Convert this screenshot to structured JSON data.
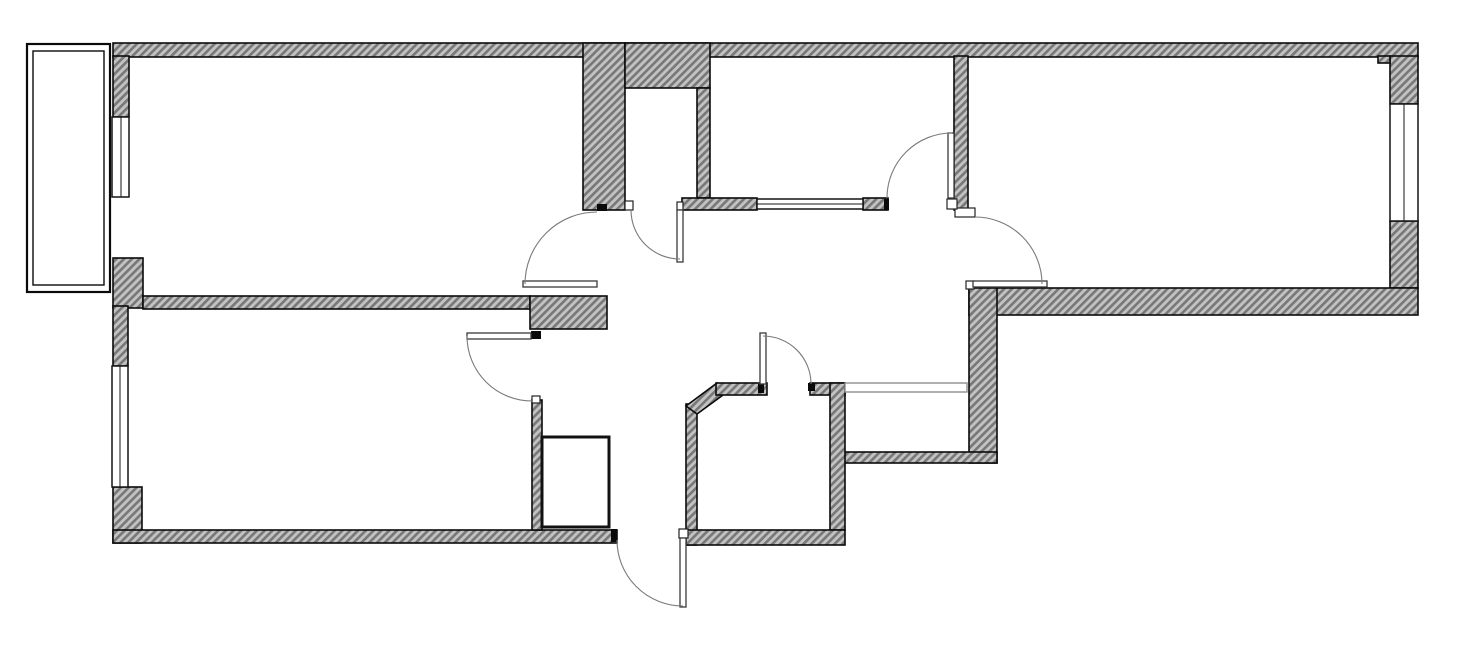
{
  "meta": {
    "description": "Black-and-white architectural floor plan of a two-bedroom apartment with balcony, drawn with hatched walls, swing-arc doors and framed windows. No text labels are rendered on the drawing.",
    "background_color": "#ffffff"
  },
  "palette": {
    "line": "#0a0a0a",
    "hatch_base": "#c2c2c2",
    "hatch_stripe": "#777777",
    "door_arc": "#7a7a7a",
    "light_partition": "#8f8f8f",
    "paper": "#ffffff"
  },
  "inventory": {
    "rooms": [
      "top-left-room",
      "bottom-left-room",
      "top-middle-room",
      "right-room",
      "hallway",
      "entrance-hall",
      "bathroom",
      "duct-shaft",
      "wall-closet",
      "balcony"
    ],
    "door_count": 7,
    "window_count": 4,
    "swing_door_arcs": 7
  },
  "plan": {
    "width": 1459,
    "height": 650,
    "shapes": [
      {
        "t": "rect",
        "cls": "wall",
        "name": "top-exterior-wall",
        "x": 113,
        "y": 43,
        "w": 1305,
        "h": 14
      },
      {
        "t": "rect",
        "cls": "wall",
        "name": "left-exterior-wall-upper",
        "x": 113,
        "y": 56,
        "w": 16,
        "h": 61
      },
      {
        "t": "rect",
        "cls": "wall",
        "name": "left-exterior-wall-pier",
        "x": 113,
        "y": 258,
        "w": 30,
        "h": 50
      },
      {
        "t": "rect",
        "cls": "wall",
        "name": "left-exterior-wall-mid",
        "x": 113,
        "y": 306,
        "w": 15,
        "h": 60
      },
      {
        "t": "rect",
        "cls": "wall",
        "name": "left-exterior-wall-lower",
        "x": 113,
        "y": 487,
        "w": 29,
        "h": 56
      },
      {
        "t": "rect",
        "cls": "wall",
        "name": "bottom-exterior-wall-left",
        "x": 113,
        "y": 530,
        "w": 504,
        "h": 13
      },
      {
        "t": "rect",
        "cls": "wall",
        "name": "right-exterior-wall-upper",
        "x": 1390,
        "y": 56,
        "w": 28,
        "h": 48
      },
      {
        "t": "rect",
        "cls": "wall",
        "name": "right-exterior-wall-lower",
        "x": 1390,
        "y": 221,
        "w": 28,
        "h": 67
      },
      {
        "t": "rect",
        "cls": "wall",
        "name": "right-room-bottom-wall",
        "x": 969,
        "y": 288,
        "w": 449,
        "h": 27
      },
      {
        "t": "rect",
        "cls": "wall",
        "name": "hallway-right-wall",
        "x": 969,
        "y": 288,
        "w": 28,
        "h": 175
      },
      {
        "t": "rect",
        "cls": "wall",
        "name": "duct-shaft-bottom-wall",
        "x": 843,
        "y": 452,
        "w": 154,
        "h": 11
      },
      {
        "t": "rect",
        "cls": "wall",
        "name": "closet-left-column",
        "x": 583,
        "y": 43,
        "w": 42,
        "h": 167
      },
      {
        "t": "rect",
        "cls": "wall",
        "name": "closet-top-wall",
        "x": 625,
        "y": 43,
        "w": 85,
        "h": 45
      },
      {
        "t": "rect",
        "cls": "wall",
        "name": "closet-right-wall",
        "x": 697,
        "y": 88,
        "w": 13,
        "h": 110
      },
      {
        "t": "rect",
        "cls": "wall",
        "name": "middleroom-bottom-wall-left",
        "x": 682,
        "y": 198,
        "w": 75,
        "h": 12
      },
      {
        "t": "rect",
        "cls": "wall",
        "name": "middleroom-bottom-wall-right",
        "x": 863,
        "y": 198,
        "w": 25,
        "h": 12
      },
      {
        "t": "rect",
        "cls": "wall",
        "name": "middleroom-right-wall",
        "x": 954,
        "y": 56,
        "w": 14,
        "h": 154
      },
      {
        "t": "rect",
        "cls": "wall",
        "name": "rooms-divider-wall",
        "x": 143,
        "y": 296,
        "w": 387,
        "h": 13
      },
      {
        "t": "rect",
        "cls": "wall",
        "name": "hall-doorway-pier",
        "x": 530,
        "y": 296,
        "w": 77,
        "h": 33
      },
      {
        "t": "rect",
        "cls": "wall",
        "name": "bottomroom-right-wall",
        "x": 532,
        "y": 400,
        "w": 10,
        "h": 130
      },
      {
        "t": "rect",
        "cls": "wall",
        "name": "bathroom-left-wall",
        "x": 686,
        "y": 404,
        "w": 11,
        "h": 141
      },
      {
        "t": "poly",
        "cls": "wall",
        "name": "bathroom-chamfer-wall",
        "pts": "686,406 717,383 723,395 697,414"
      },
      {
        "t": "rect",
        "cls": "wall",
        "name": "bathroom-top-wall-left",
        "x": 716,
        "y": 383,
        "w": 51,
        "h": 12
      },
      {
        "t": "rect",
        "cls": "wall",
        "name": "bathroom-top-wall-right",
        "x": 810,
        "y": 383,
        "w": 35,
        "h": 12
      },
      {
        "t": "rect",
        "cls": "wall",
        "name": "bathroom-right-wall",
        "x": 830,
        "y": 383,
        "w": 15,
        "h": 147
      },
      {
        "t": "rect",
        "cls": "wall",
        "name": "bathroom-bottom-wall",
        "x": 686,
        "y": 530,
        "w": 159,
        "h": 15
      },
      {
        "t": "rect",
        "cls": "wall",
        "name": "rightroom-corner-notch",
        "x": 1378,
        "y": 56,
        "w": 12,
        "h": 7
      },
      {
        "t": "rect",
        "cls": "window",
        "name": "window-left-upper",
        "x": 112,
        "y": 117,
        "w": 17,
        "h": 80
      },
      {
        "t": "line",
        "cls": "mull",
        "name": "window-left-upper-mullion",
        "x1": 121,
        "y1": 117,
        "x2": 121,
        "y2": 197
      },
      {
        "t": "rect",
        "cls": "window",
        "name": "window-left-lower",
        "x": 112,
        "y": 366,
        "w": 16,
        "h": 121
      },
      {
        "t": "line",
        "cls": "mull",
        "name": "window-left-lower-mullion",
        "x1": 120,
        "y1": 366,
        "x2": 120,
        "y2": 487
      },
      {
        "t": "rect",
        "cls": "window",
        "name": "window-right",
        "x": 1390,
        "y": 104,
        "w": 28,
        "h": 117
      },
      {
        "t": "line",
        "cls": "mull",
        "name": "window-right-mullion",
        "x1": 1404,
        "y1": 104,
        "x2": 1404,
        "y2": 221
      },
      {
        "t": "rect",
        "cls": "window",
        "name": "window-middleroom-internal",
        "x": 757,
        "y": 199,
        "w": 106,
        "h": 10
      },
      {
        "t": "line",
        "cls": "mull",
        "name": "window-middleroom-mullion",
        "x1": 757,
        "y1": 204,
        "x2": 863,
        "y2": 204
      },
      {
        "t": "rect",
        "cls": "thin",
        "name": "duct-shaft-front-partition",
        "x": 845,
        "y": 383,
        "w": 122,
        "h": 9
      },
      {
        "t": "rect",
        "cls": "balc",
        "name": "balcony-outer-parapet",
        "x": 27,
        "y": 44,
        "w": 83,
        "h": 248
      },
      {
        "t": "rect",
        "cls": "balc2",
        "name": "balcony-inner-parapet",
        "x": 33,
        "y": 51,
        "w": 71,
        "h": 234
      },
      {
        "t": "rect",
        "cls": "cupboard",
        "name": "hall-cupboard",
        "x": 542,
        "y": 437,
        "w": 67,
        "h": 90
      },
      {
        "t": "rect",
        "cls": "tick",
        "name": "jamb-topleft-door-head",
        "x": 597,
        "y": 204,
        "w": 10,
        "h": 7
      },
      {
        "t": "rect",
        "cls": "tick",
        "name": "jamb-bottomroom-door",
        "x": 531,
        "y": 331,
        "w": 10,
        "h": 8
      },
      {
        "t": "rect",
        "cls": "tick",
        "name": "jamb-middleroom-door",
        "x": 884,
        "y": 199,
        "w": 5,
        "h": 11
      },
      {
        "t": "rect",
        "cls": "tick",
        "name": "jamb-entrance-left",
        "x": 611,
        "y": 529,
        "w": 6,
        "h": 13
      },
      {
        "t": "rect",
        "cls": "tick",
        "name": "jamb-bathroom-door-left",
        "x": 758,
        "y": 384,
        "w": 6,
        "h": 9
      },
      {
        "t": "rect",
        "cls": "tick",
        "name": "jamb-bathroom-door-right",
        "x": 808,
        "y": 383,
        "w": 7,
        "h": 8
      },
      {
        "t": "rect",
        "cls": "hinge",
        "name": "hinge-plate-closet-column",
        "x": 625,
        "y": 201,
        "w": 8,
        "h": 9
      },
      {
        "t": "rect",
        "cls": "hinge",
        "name": "hinge-plate-closet-door",
        "x": 677,
        "y": 202,
        "w": 6,
        "h": 8
      },
      {
        "t": "rect",
        "cls": "hinge",
        "name": "hinge-plate-rightroom-door",
        "x": 966,
        "y": 281,
        "w": 8,
        "h": 8
      },
      {
        "t": "rect",
        "cls": "hinge",
        "name": "hinge-plate-rightroom-step",
        "x": 955,
        "y": 208,
        "w": 20,
        "h": 9
      },
      {
        "t": "rect",
        "cls": "hinge",
        "name": "hinge-plate-middleroom-door",
        "x": 947,
        "y": 199,
        "w": 10,
        "h": 10
      },
      {
        "t": "rect",
        "cls": "hinge",
        "name": "hinge-plate-entrance-door",
        "x": 679,
        "y": 529,
        "w": 9,
        "h": 9
      },
      {
        "t": "rect",
        "cls": "hinge",
        "name": "hinge-plate-bottomroom-door",
        "x": 532,
        "y": 396,
        "w": 8,
        "h": 7
      },
      {
        "t": "rect",
        "cls": "leaf",
        "name": "door-leaf-topleft-room",
        "x": 523,
        "y": 281,
        "w": 74,
        "h": 6
      },
      {
        "t": "rect",
        "cls": "leaf",
        "name": "door-leaf-bottomleft-room",
        "x": 467,
        "y": 333,
        "w": 64,
        "h": 6
      },
      {
        "t": "rect",
        "cls": "leaf",
        "name": "door-leaf-closet",
        "x": 677,
        "y": 210,
        "w": 6,
        "h": 52
      },
      {
        "t": "rect",
        "cls": "leaf",
        "name": "door-leaf-middleroom",
        "x": 948,
        "y": 133,
        "w": 6,
        "h": 65
      },
      {
        "t": "rect",
        "cls": "leaf",
        "name": "door-leaf-rightroom",
        "x": 973,
        "y": 281,
        "w": 74,
        "h": 6
      },
      {
        "t": "rect",
        "cls": "leaf",
        "name": "door-leaf-bathroom",
        "x": 760,
        "y": 333,
        "w": 6,
        "h": 51
      },
      {
        "t": "rect",
        "cls": "leaf",
        "name": "door-leaf-entrance",
        "x": 680,
        "y": 538,
        "w": 6,
        "h": 69
      },
      {
        "t": "path",
        "cls": "arc",
        "name": "door-swing-topleft-room",
        "d": "M 525 284 A 72 72 0 0 1 597 212"
      },
      {
        "t": "path",
        "cls": "arc",
        "name": "door-swing-bottomleft-room",
        "d": "M 467 336 A 65 65 0 0 0 532 401"
      },
      {
        "t": "path",
        "cls": "arc",
        "name": "door-swing-closet",
        "d": "M 631 210 A 49 49 0 0 0 680 259"
      },
      {
        "t": "path",
        "cls": "arc",
        "name": "door-swing-middleroom",
        "d": "M 887 198 A 65 65 0 0 1 952 133"
      },
      {
        "t": "path",
        "cls": "arc",
        "name": "door-swing-rightroom",
        "d": "M 975 217 A 67 67 0 0 1 1042 284"
      },
      {
        "t": "path",
        "cls": "arc",
        "name": "door-swing-bathroom",
        "d": "M 763 336 A 48 48 0 0 1 811 384"
      },
      {
        "t": "path",
        "cls": "arc",
        "name": "door-swing-entrance",
        "d": "M 617 540 A 66 66 0 0 0 683 606"
      }
    ]
  }
}
